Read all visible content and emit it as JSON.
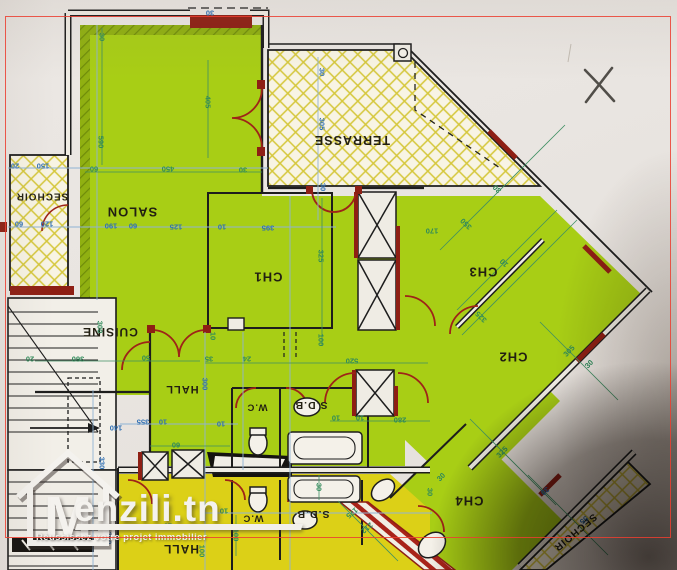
{
  "watermark": {
    "logo_letter": "M",
    "brand": "enzili.tn",
    "tagline": "Réussissez votre projet immobilier"
  },
  "colors": {
    "room_green": "#a8ce15",
    "room_yellow": "#dcd017",
    "wall_maroon": "#8e1f14",
    "dim_blue": "#2f6fb4",
    "dim_green": "#2f8a5a",
    "frame_red": "#eb3e30"
  },
  "rooms": [
    {
      "label": "SALON",
      "x": 132,
      "y": 212,
      "rot": 180,
      "fs": 13
    },
    {
      "label": "SECHOIR",
      "x": 42,
      "y": 196,
      "rot": 180,
      "fs": 10
    },
    {
      "label": "TERRASSE",
      "x": 352,
      "y": 140,
      "rot": 180,
      "fs": 12.5
    },
    {
      "label": "CH1",
      "x": 268,
      "y": 277,
      "rot": 180,
      "fs": 13
    },
    {
      "label": "CH3",
      "x": 483,
      "y": 272,
      "rot": 180,
      "fs": 13
    },
    {
      "label": "CH2",
      "x": 513,
      "y": 357,
      "rot": 180,
      "fs": 13
    },
    {
      "label": "CH4",
      "x": 469,
      "y": 501,
      "rot": 180,
      "fs": 13
    },
    {
      "label": "CUISINE",
      "x": 110,
      "y": 332,
      "rot": 180,
      "fs": 12
    },
    {
      "label": "HALL",
      "x": 182,
      "y": 389,
      "rot": 180,
      "fs": 11
    },
    {
      "label": "W.C",
      "x": 257,
      "y": 407,
      "rot": 180,
      "fs": 9.5
    },
    {
      "label": "S.D.B",
      "x": 311,
      "y": 405,
      "rot": 180,
      "fs": 10.5
    },
    {
      "label": "W.C",
      "x": 253,
      "y": 518,
      "rot": 180,
      "fs": 9.5
    },
    {
      "label": "S.D.B",
      "x": 313,
      "y": 514,
      "rot": 180,
      "fs": 10.5
    },
    {
      "label": "HALL",
      "x": 181,
      "y": 549,
      "rot": 180,
      "fs": 12
    },
    {
      "label": "SECHOIR",
      "x": 575,
      "y": 532,
      "rot": 140,
      "fs": 10
    }
  ],
  "dims": [
    {
      "t": "30",
      "x": 102,
      "y": 37,
      "rot": 90,
      "c": "g"
    },
    {
      "t": "405",
      "x": 208,
      "y": 102,
      "rot": 90,
      "c": "g"
    },
    {
      "t": "590",
      "x": 101,
      "y": 142,
      "rot": 90,
      "c": "g"
    },
    {
      "t": "60",
      "x": 94,
      "y": 169,
      "rot": 180,
      "c": "g"
    },
    {
      "t": "450",
      "x": 168,
      "y": 169,
      "rot": 180,
      "c": "g"
    },
    {
      "t": "30",
      "x": 243,
      "y": 170,
      "rot": 180,
      "c": "g"
    },
    {
      "t": "150",
      "x": 43,
      "y": 166,
      "rot": 180,
      "c": "b"
    },
    {
      "t": "20",
      "x": 15,
      "y": 166,
      "rot": 180,
      "c": "b"
    },
    {
      "t": "60",
      "x": 19,
      "y": 224,
      "rot": 180,
      "c": "b"
    },
    {
      "t": "120",
      "x": 47,
      "y": 224,
      "rot": 180,
      "c": "b"
    },
    {
      "t": "190",
      "x": 111,
      "y": 226,
      "rot": 180,
      "c": "b"
    },
    {
      "t": "60",
      "x": 133,
      "y": 226,
      "rot": 180,
      "c": "b"
    },
    {
      "t": "125",
      "x": 176,
      "y": 227,
      "rot": 180,
      "c": "b"
    },
    {
      "t": "10",
      "x": 222,
      "y": 227,
      "rot": 180,
      "c": "b"
    },
    {
      "t": "395",
      "x": 268,
      "y": 228,
      "rot": 180,
      "c": "b"
    },
    {
      "t": "30",
      "x": 322,
      "y": 72,
      "rot": 90,
      "c": "b"
    },
    {
      "t": "305",
      "x": 322,
      "y": 124,
      "rot": 90,
      "c": "b"
    },
    {
      "t": "30",
      "x": 323,
      "y": 187,
      "rot": 90,
      "c": "b"
    },
    {
      "t": "30",
      "x": 210,
      "y": 13,
      "rot": 180,
      "c": "b"
    },
    {
      "t": "325",
      "x": 321,
      "y": 256,
      "rot": 90,
      "c": "g"
    },
    {
      "t": "100",
      "x": 321,
      "y": 340,
      "rot": 90,
      "c": "g"
    },
    {
      "t": "520",
      "x": 352,
      "y": 361,
      "rot": 180,
      "c": "g"
    },
    {
      "t": "24",
      "x": 247,
      "y": 359,
      "rot": 180,
      "c": "g"
    },
    {
      "t": "35",
      "x": 209,
      "y": 359,
      "rot": 180,
      "c": "g"
    },
    {
      "t": "10",
      "x": 213,
      "y": 336,
      "rot": 90,
      "c": "g"
    },
    {
      "t": "300",
      "x": 100,
      "y": 327,
      "rot": 90,
      "c": "g"
    },
    {
      "t": "360",
      "x": 78,
      "y": 359,
      "rot": 180,
      "c": "g"
    },
    {
      "t": "20",
      "x": 30,
      "y": 359,
      "rot": 180,
      "c": "g"
    },
    {
      "t": "50",
      "x": 146,
      "y": 358,
      "rot": 180,
      "c": "g"
    },
    {
      "t": "30",
      "x": 497,
      "y": 189,
      "rot": 225,
      "c": "g"
    },
    {
      "t": "350",
      "x": 466,
      "y": 224,
      "rot": 225,
      "c": "g"
    },
    {
      "t": "170",
      "x": 432,
      "y": 231,
      "rot": 180,
      "c": "g"
    },
    {
      "t": "10",
      "x": 504,
      "y": 263,
      "rot": 225,
      "c": "g"
    },
    {
      "t": "325",
      "x": 481,
      "y": 317,
      "rot": 225,
      "c": "g"
    },
    {
      "t": "305",
      "x": 569,
      "y": 351,
      "rot": 315,
      "c": "g"
    },
    {
      "t": "30",
      "x": 589,
      "y": 364,
      "rot": 315,
      "c": "g"
    },
    {
      "t": "280",
      "x": 400,
      "y": 420,
      "rot": 180,
      "c": "g"
    },
    {
      "t": "10",
      "x": 336,
      "y": 418,
      "rot": 180,
      "c": "g"
    },
    {
      "t": "10",
      "x": 360,
      "y": 418,
      "rot": 180,
      "c": "g"
    },
    {
      "t": "355",
      "x": 143,
      "y": 422,
      "rot": 180,
      "c": "b"
    },
    {
      "t": "10",
      "x": 163,
      "y": 422,
      "rot": 180,
      "c": "b"
    },
    {
      "t": "10",
      "x": 221,
      "y": 424,
      "rot": 180,
      "c": "b"
    },
    {
      "t": "300",
      "x": 205,
      "y": 384,
      "rot": 90,
      "c": "b"
    },
    {
      "t": "330",
      "x": 102,
      "y": 463,
      "rot": 90,
      "c": "b"
    },
    {
      "t": "140",
      "x": 116,
      "y": 428,
      "rot": 180,
      "c": "b"
    },
    {
      "t": "250",
      "x": 109,
      "y": 538,
      "rot": 90,
      "c": "b"
    },
    {
      "t": "60",
      "x": 176,
      "y": 445,
      "rot": 180,
      "c": "g"
    },
    {
      "t": "10",
      "x": 224,
      "y": 511,
      "rot": 180,
      "c": "g"
    },
    {
      "t": "100",
      "x": 236,
      "y": 535,
      "rot": 90,
      "c": "g"
    },
    {
      "t": "30",
      "x": 319,
      "y": 487,
      "rot": 90,
      "c": "g"
    },
    {
      "t": "175",
      "x": 352,
      "y": 513,
      "rot": 140,
      "c": "g"
    },
    {
      "t": "212",
      "x": 367,
      "y": 528,
      "rot": 140,
      "c": "g"
    },
    {
      "t": "10",
      "x": 168,
      "y": 526,
      "rot": 180,
      "c": "g"
    },
    {
      "t": "100",
      "x": 202,
      "y": 551,
      "rot": 90,
      "c": "g"
    },
    {
      "t": "325",
      "x": 502,
      "y": 452,
      "rot": 315,
      "c": "g"
    },
    {
      "t": "30",
      "x": 441,
      "y": 477,
      "rot": 315,
      "c": "g"
    },
    {
      "t": "30",
      "x": 430,
      "y": 492,
      "rot": 90,
      "c": "g"
    },
    {
      "t": "30",
      "x": 545,
      "y": 491,
      "rot": 140,
      "c": "b"
    },
    {
      "t": "55",
      "x": 584,
      "y": 520,
      "rot": 140,
      "c": "b"
    }
  ]
}
